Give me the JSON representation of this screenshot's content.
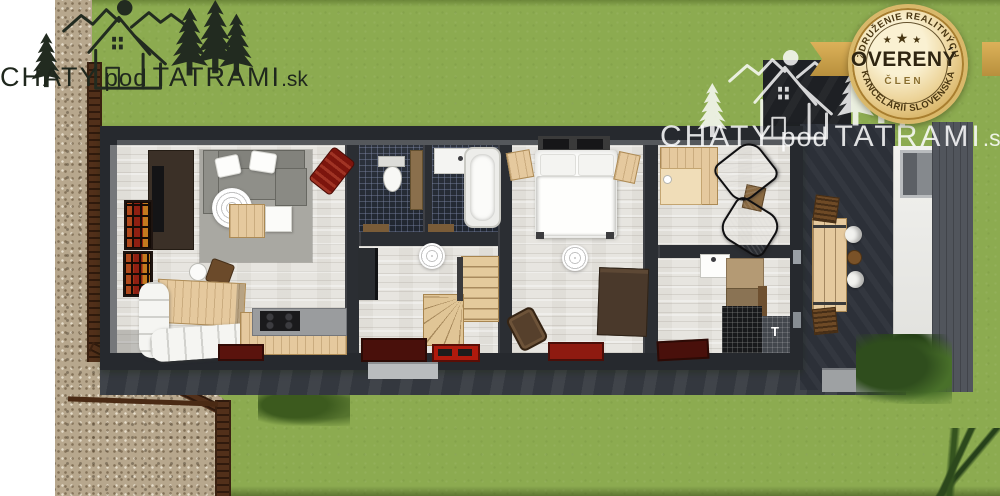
{
  "branding": {
    "primary": {
      "chaty": "CHATY",
      "pod": "pod",
      "tatrami": "TATRAMI",
      "sk": ".sk"
    },
    "watermark": {
      "chaty": "CHATY",
      "pod": "pod",
      "tatrami": "TATRAMI",
      "sk": ".sk"
    }
  },
  "badge": {
    "arc_top": "ZDRUŽENIE REALITNÝCH",
    "arc_bottom": "KANCELÁRIÍ SLOVENSKA",
    "stars": [
      "★",
      "★",
      "★"
    ],
    "title": "OVERENÝ",
    "subtitle": "ČLEN"
  },
  "plan": {
    "entry_marking": "T"
  },
  "colors": {
    "grass": "#8cab50",
    "stone_path": "#b7a78d",
    "fence_brown": "#52301a",
    "wall_dark": "#26292e",
    "terrace": "#2c3038",
    "floor_wood": "#e7e5e0",
    "tile_dark": "#202630",
    "furniture_wood": "#e5c99e",
    "sofa_gray": "#8f8f89",
    "accent_red": "#8e1a10",
    "badge_gold": "#d9b86a",
    "badge_text": "#4a3712",
    "logo_dark": "#222b20",
    "logo_light": "#ffffff"
  }
}
